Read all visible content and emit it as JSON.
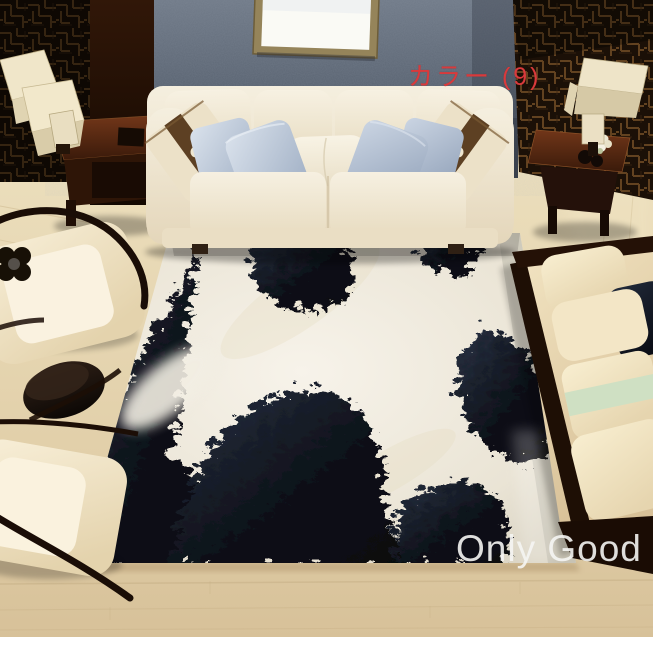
{
  "photo": {
    "alt": "Overhead living room scene: black-and-white cowhide-print rug on wood floor, cream leather sofa with silver-blue and brown-band pillows, two cream lounge chairs, side tables with cube lamps, chaise bench with cream pillows, lattice screen walls",
    "color_label": "カラー (9)",
    "watermark": "Only Good"
  },
  "colors": {
    "label_red": "#d93a3c",
    "watermark_white": "#f4f4f2",
    "rug_white": "#f2eee3",
    "rug_black": "#10141e",
    "sofa_cream": "#f1ead9",
    "pillow_silver_blue": "#b7c4d5",
    "pillow_brown_band": "#5d4023",
    "pillow_sage_band": "#cfe0c3",
    "chair_cream": "#f2e7cc",
    "wall_blue_gray": "#57616f",
    "lattice_brown": "#6a4722",
    "floor_wood": "#dcc9a2",
    "table_mahogany": "#46220f"
  }
}
